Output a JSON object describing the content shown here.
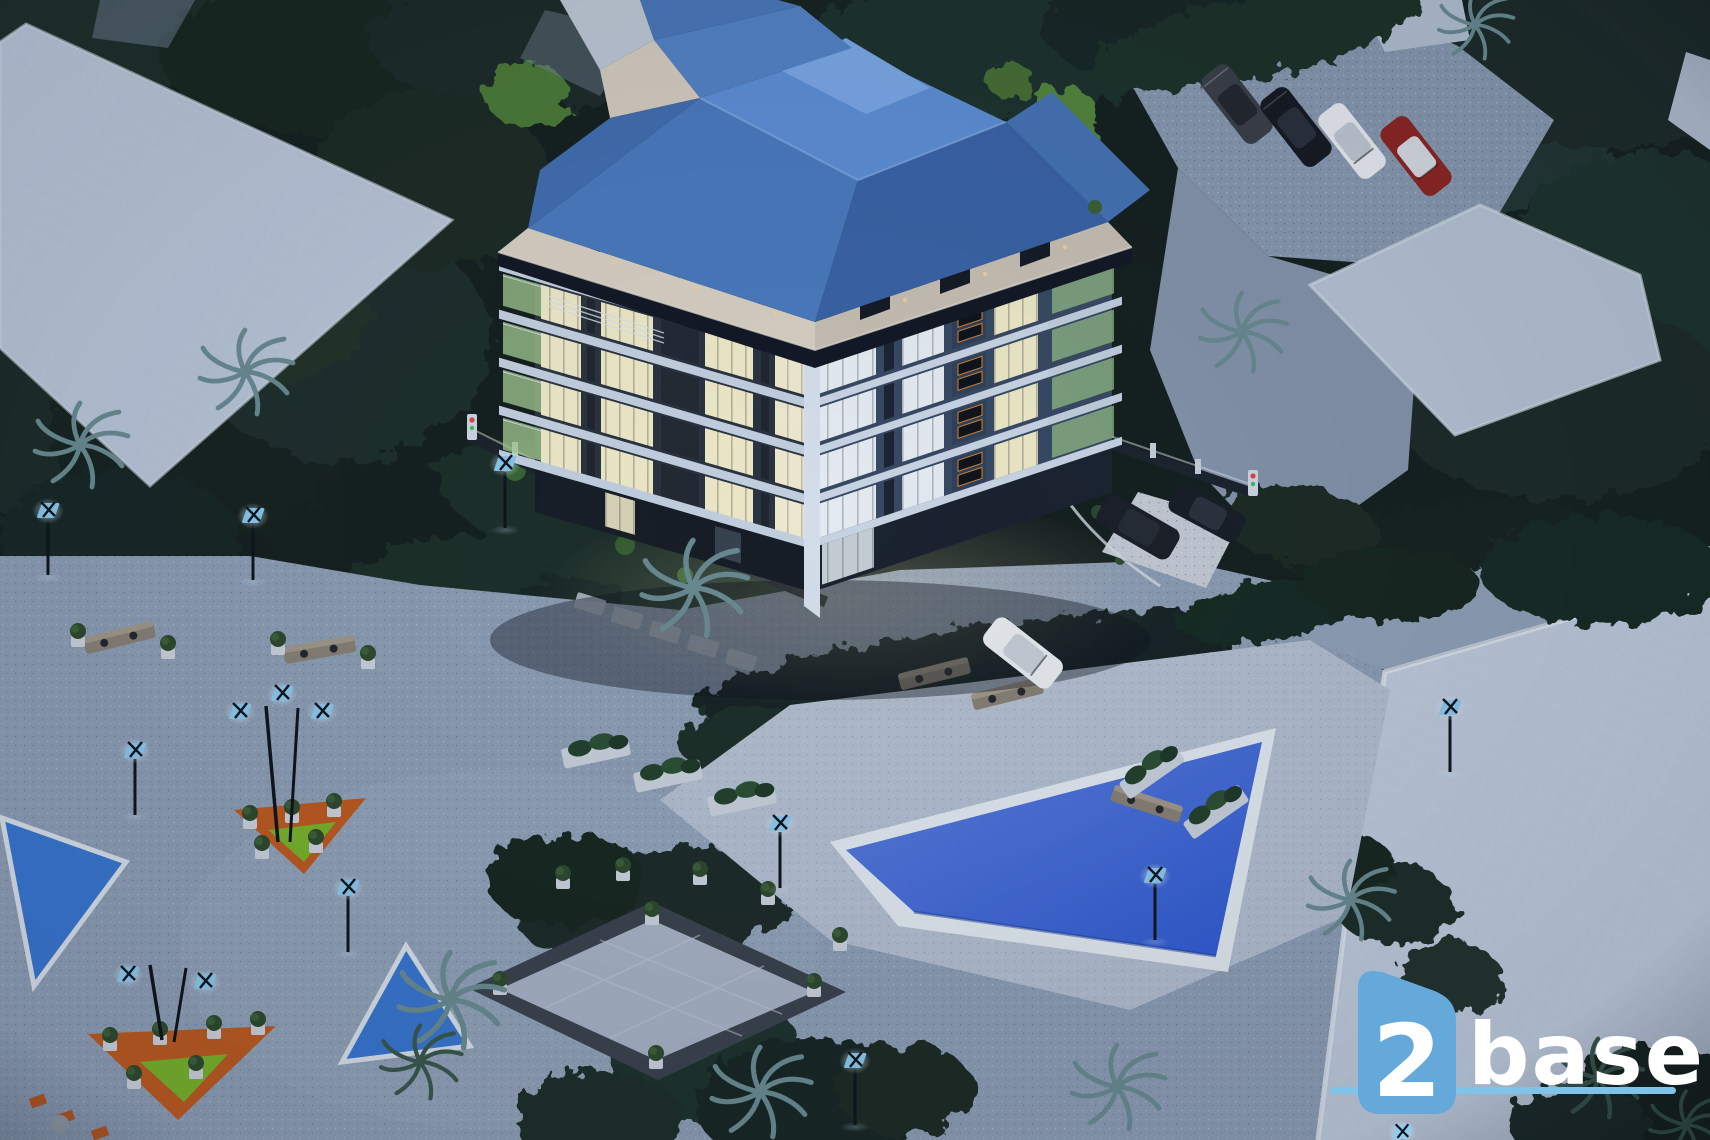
{
  "meta": {
    "type": "architectural-render",
    "view": "aerial",
    "time_of_day": "dusk"
  },
  "watermark": {
    "number": "2",
    "name": "base",
    "shield_color": "#64a9da",
    "line_color": "#7fc4e8",
    "text_color": "#ffffff"
  },
  "palette": {
    "vegetation_dark": "#16231f",
    "flat_roof": "#bccadb",
    "paving": "#8fa0b6",
    "pool_deck": "#b6c2d2",
    "pool_water": "#2f5bd4",
    "pond_water": "#3877d2",
    "roof_main": "#4b7cc0",
    "roof_light": "#5e92d8",
    "roof_dark": "#3a64a8",
    "roof_top": "#7cabe9",
    "fascia_cream": "#ded5c6",
    "window_warm": "#f6f0cc",
    "window_cool": "#eef4f8",
    "balcony_glass": "#a9cf93",
    "panel_dark": "#232931",
    "accent_orange": "#c05a1e",
    "accent_green": "#7ab529",
    "lamp_panel": "#8ecdf0",
    "car_red": "#8e2420",
    "car_white": "#eef1f4",
    "car_dark": "#1a1e26"
  },
  "scene": {
    "building_floors": 5,
    "parking_cars": 4,
    "courtyard_cars": 3,
    "pools": 1,
    "ponds": 2,
    "plaza_triangle_islands": 2
  }
}
